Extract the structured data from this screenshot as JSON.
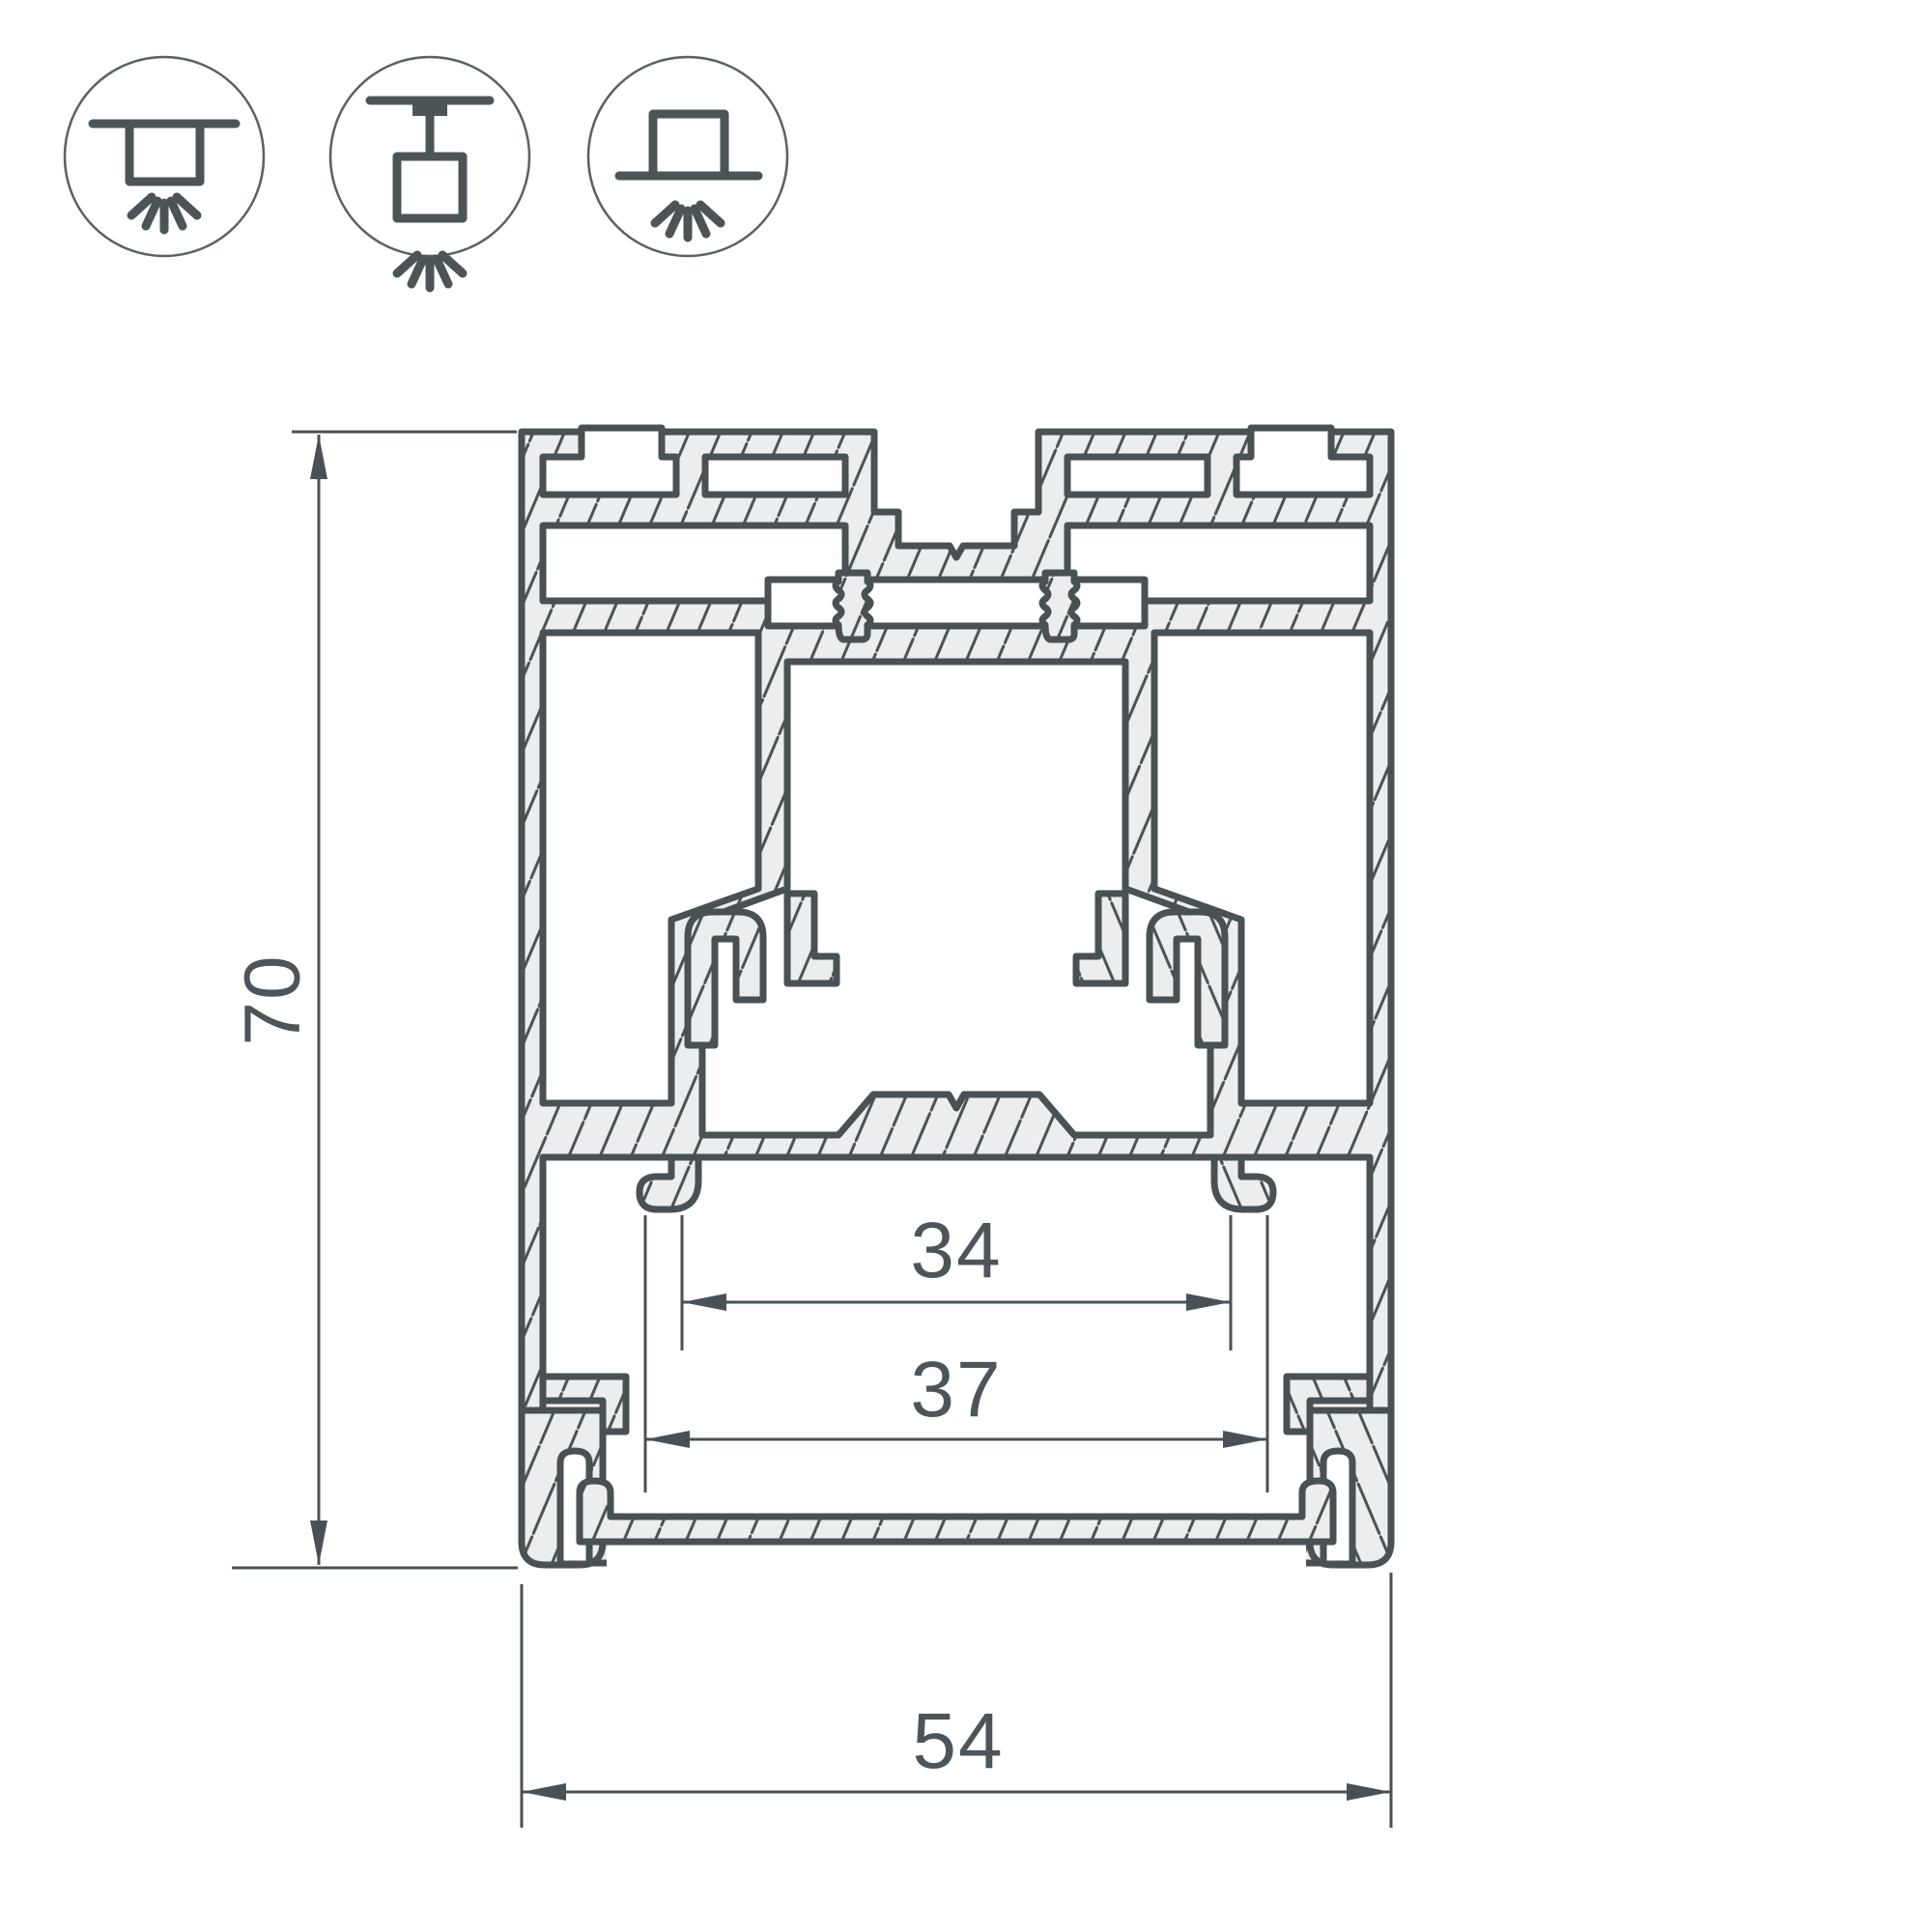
{
  "drawing": {
    "title": "aluminum-led-profile-cross-section",
    "dim_height": "70",
    "dim_inner_width": "34",
    "dim_opening_width": "37",
    "dim_outer_width": "54"
  },
  "icons": {
    "surface": "surface-ceiling-mount-icon",
    "pendant": "suspended-mount-icon",
    "recessed": "recessed-mount-icon"
  },
  "colors": {
    "outline": "#4a5154",
    "metal_fill": "#ebedee",
    "dimension_text": "#4d545a",
    "background": "#ffffff"
  }
}
